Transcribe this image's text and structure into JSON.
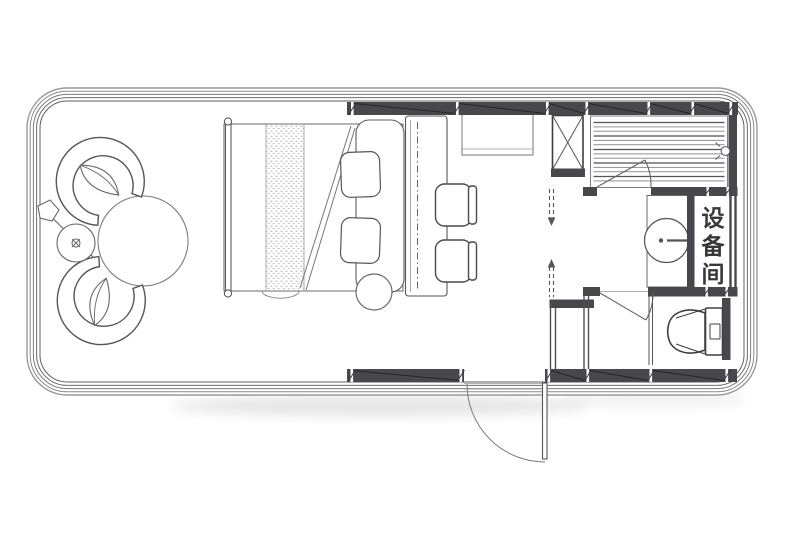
{
  "labels": {
    "equipment_room": "设备间",
    "equipment_room_chars": [
      "设",
      "备",
      "间"
    ]
  },
  "colors": {
    "background": "#ffffff",
    "wall_fill": "#48484c",
    "shell_line": "#8d8d8d",
    "furniture_line": "#5a5a5e",
    "light_line": "#9a9a9a",
    "label_text": "#38383a"
  }
}
